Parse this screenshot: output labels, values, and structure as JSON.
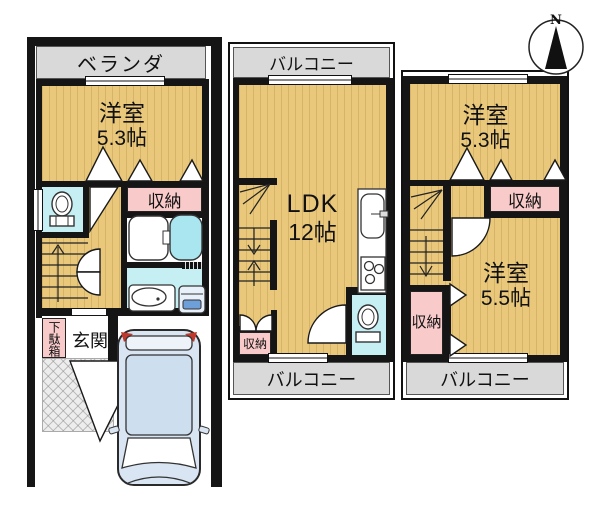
{
  "compass": {
    "north": "N"
  },
  "floors": {
    "f1": {
      "veranda": "ベランダ",
      "bedroom_name": "洋室",
      "bedroom_size": "5.3帖",
      "closet": "収納",
      "shoe_cabinet": "下駄箱",
      "entrance": "玄関"
    },
    "f2": {
      "balcony_top": "バルコニー",
      "ldk_name": "LDK",
      "ldk_size": "12帖",
      "closet": "収納",
      "balcony_bottom": "バルコニー"
    },
    "f3": {
      "bedroom1_name": "洋室",
      "bedroom1_size": "5.3帖",
      "closet_upper": "収納",
      "bedroom2_name": "洋室",
      "bedroom2_size": "5.5帖",
      "closet_lower": "収納",
      "balcony": "バルコニー"
    }
  },
  "colors": {
    "wall": "#151515",
    "floor_tan": "#e9c87c",
    "closet_pink": "#f9caca",
    "wet_area_cyan": "#c6eff4",
    "bathtub_cyan": "#a9e6ef",
    "balcony_gray": "#d9d9d9",
    "car_body_blue": "#d9e5f3"
  }
}
